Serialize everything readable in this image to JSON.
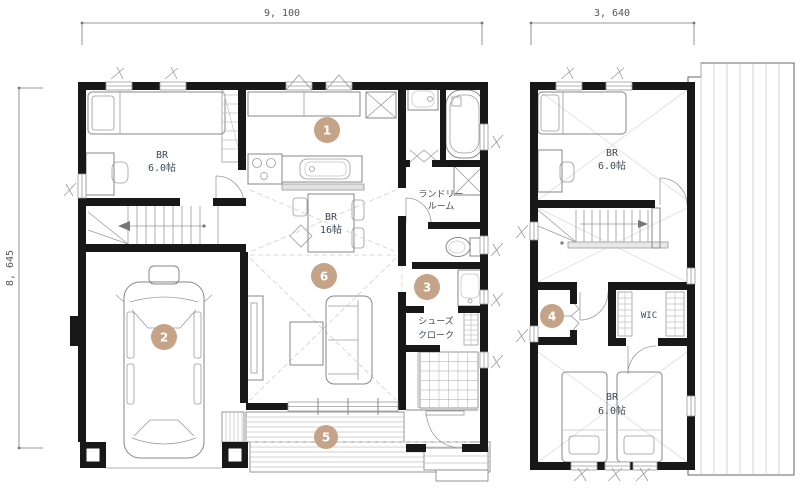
{
  "palette": {
    "wall": "#181818",
    "accent": "#c5a387",
    "label": "#3d4b57",
    "dim_text": "#555555"
  },
  "dimensions": {
    "plan1_width": "9, 100",
    "plan2_width": "3, 640",
    "plan1_height": "8, 645"
  },
  "plan1": {
    "bedroom": {
      "name": "BR",
      "area": "6.0帖"
    },
    "ldk": {
      "name": "BR",
      "area": "16帖"
    },
    "laundry": {
      "line1": "ランドリー",
      "line2": "ルーム"
    },
    "shoe_closet": {
      "line1": "シューズ",
      "line2": "クローク"
    }
  },
  "plan2": {
    "bedroom_top": {
      "name": "BR",
      "area": "6.0帖"
    },
    "wic": {
      "label": "WIC"
    },
    "bedroom_bottom": {
      "name": "BR",
      "area": "6.0帖"
    }
  },
  "markers": {
    "m1": "1",
    "m2": "2",
    "m3": "3",
    "m4": "4",
    "m5": "5",
    "m6": "6"
  }
}
